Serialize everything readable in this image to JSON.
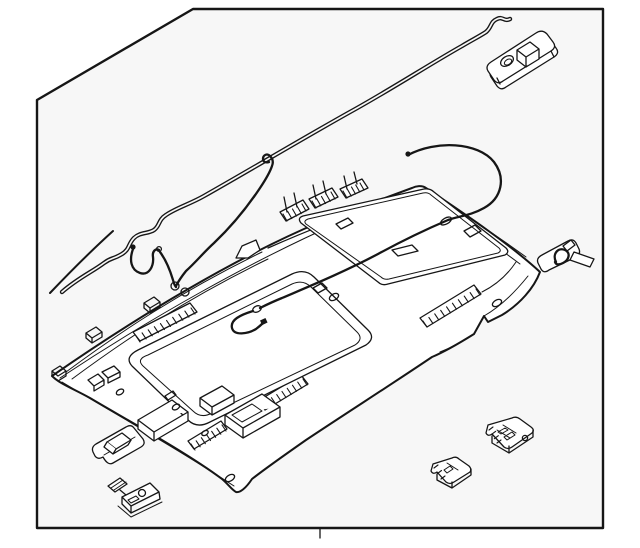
{
  "figure": {
    "kind": "exploded-parts-line-drawing",
    "subject": "vehicle headliner and roof trim assembly",
    "text_items": [],
    "components": [
      "headliner-panel",
      "front-sunroof-opening",
      "rear-sunshade-panel",
      "roof-antenna-feed-wire",
      "main-wiring-harness",
      "harness-branch-wire",
      "harness-pigtail",
      "feature-wire-loop",
      "overhead-lamp-housing",
      "retainer-clip",
      "sunvisor-clip",
      "lamp-socket",
      "cargo-lamp-large",
      "cargo-lamp-small"
    ]
  },
  "frame": {
    "shape": "rectangle-with-beveled-top-left-corner",
    "bottom_center_tick": true
  },
  "colors": {
    "line": "#161616",
    "panel": "#f7f7f7",
    "canvas": "#ffffff"
  }
}
